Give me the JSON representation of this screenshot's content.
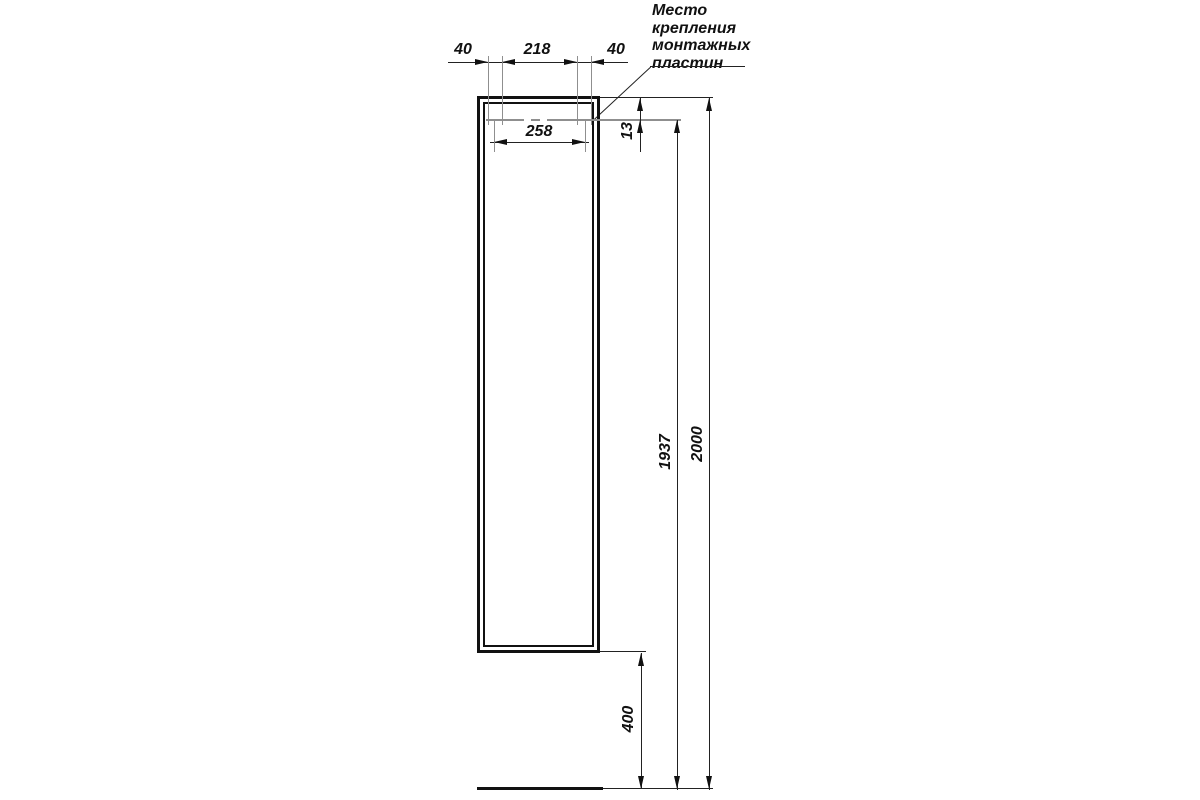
{
  "title": "Mounting drawing of tall wall-hung cabinet (side column), front view with installation dimensions",
  "note": {
    "line1": "Место",
    "line2": "крепления",
    "line3": "монтажных",
    "line4": "пластин"
  },
  "dimensions": {
    "plate_left_offset": "40",
    "plate_spacing": "218",
    "plate_right_offset": "40",
    "plate_centers_span": "258",
    "plate_top_offset": "13",
    "plate_height_above_floor": "1937",
    "total_height": "2000",
    "floor_clearance": "400"
  },
  "colors": {
    "background": "#ffffff",
    "outline": "#111111",
    "dimension_lines": "#222222",
    "extension_lines": "#777777",
    "mounting_line": "#8f8f8f",
    "text": "#111111"
  }
}
